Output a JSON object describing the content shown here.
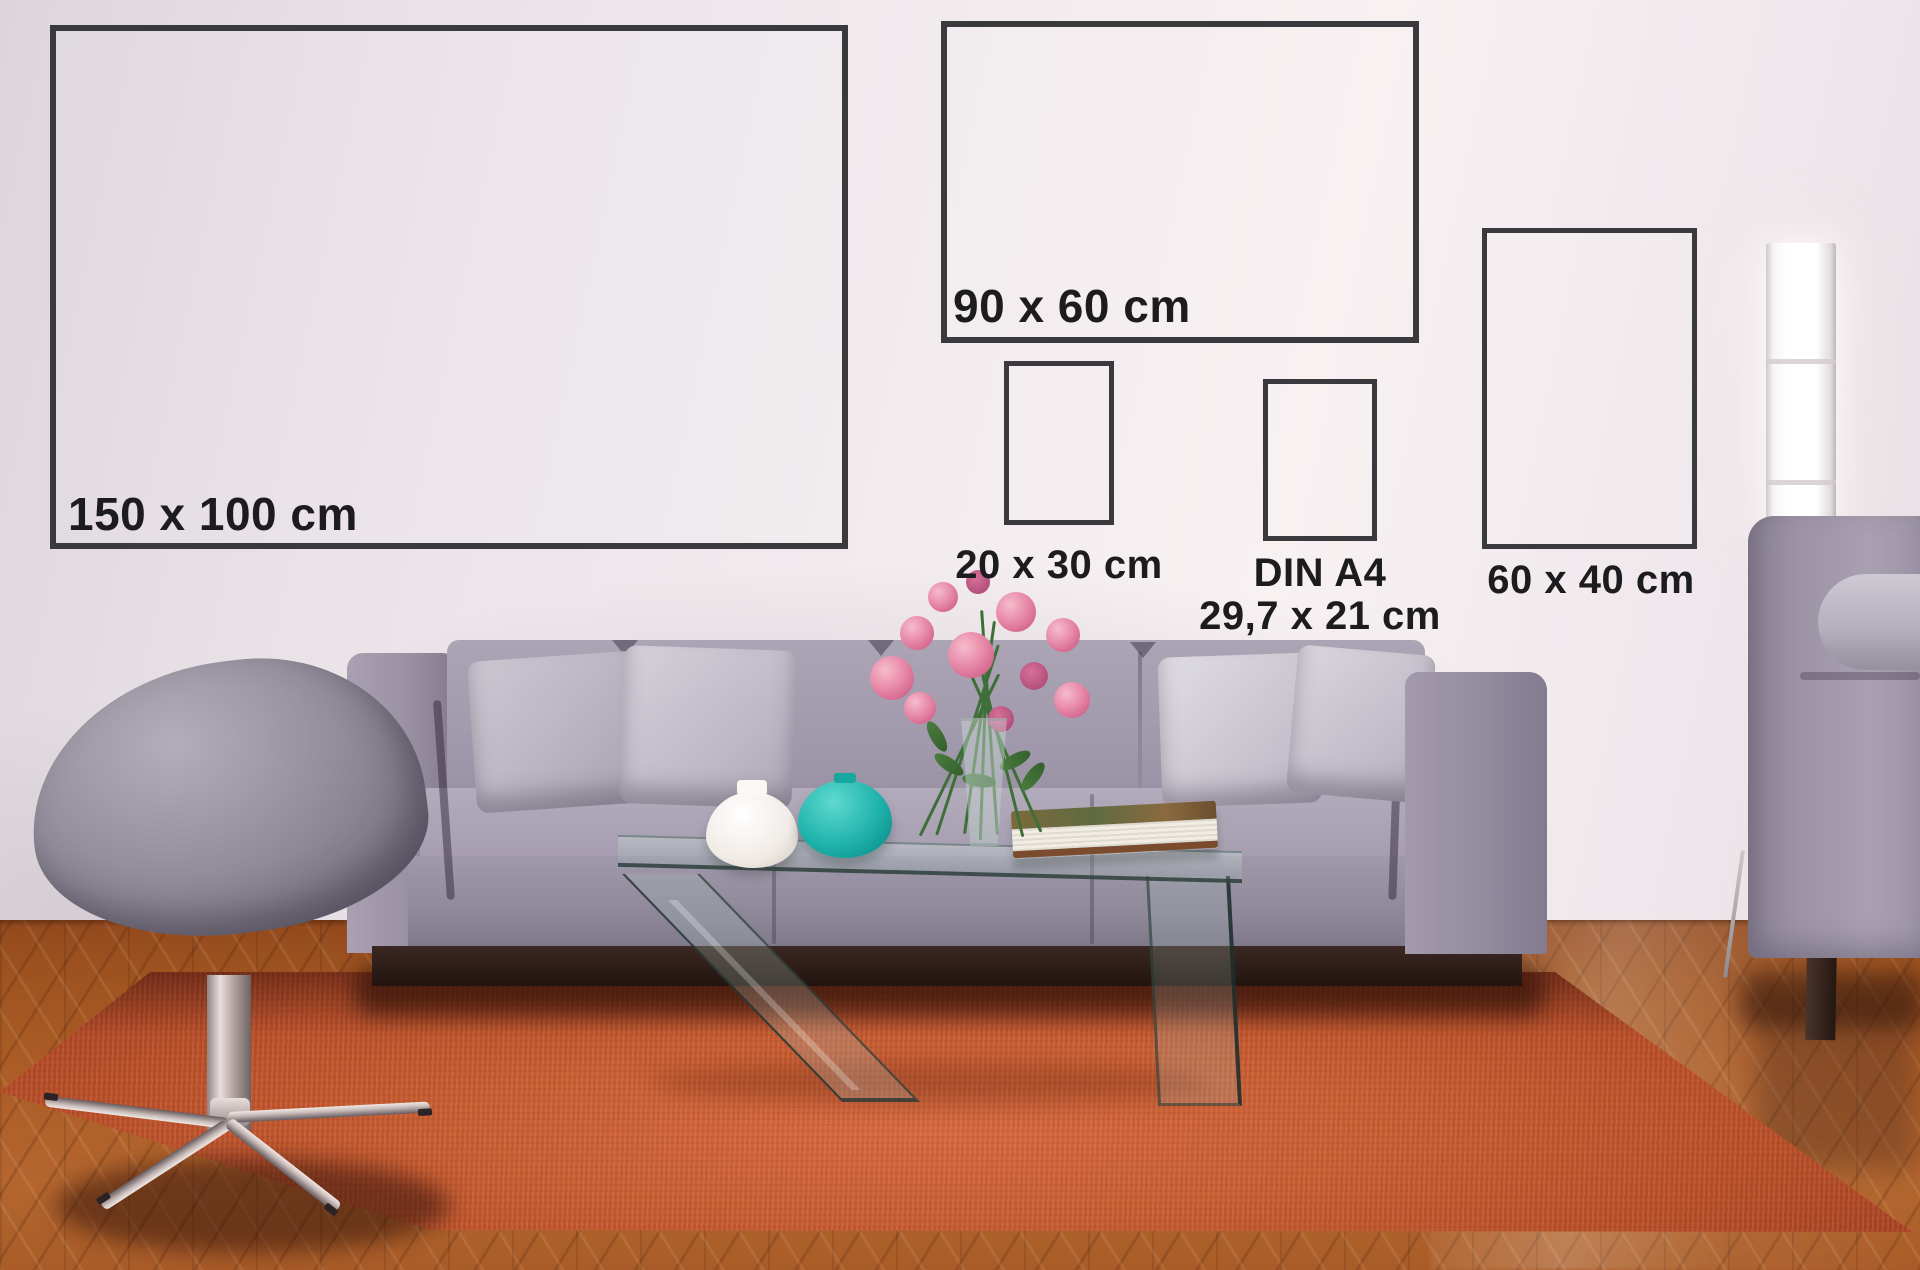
{
  "frames": [
    {
      "id": "150x100",
      "label": "150 x 100 cm"
    },
    {
      "id": "90x60",
      "label": "90 x 60 cm"
    },
    {
      "id": "20x30",
      "label": "20 x 30 cm"
    },
    {
      "id": "din_a4",
      "label": "DIN A4",
      "sublabel": "29,7 x 21 cm"
    },
    {
      "id": "60x40",
      "label": "60 x 40 cm"
    }
  ],
  "colors": {
    "frame_border": "#3a393e",
    "label_text": "#1c1b1e",
    "wall": "#f2ecef",
    "floor_wood": "#a65a27",
    "rug": "#c2522b",
    "sofa_fabric": "#9a93a3",
    "pillow_light": "#d6d3db",
    "white_vase": "#f4efec",
    "teal_vase": "#1fb3ab",
    "flower_pink": "#e27da1",
    "lamp_glow": "#ffffff",
    "plinth_dark": "#2f1d18"
  },
  "scene": {
    "objects": [
      "wall",
      "parquet-floor",
      "orange-rug",
      "sofa",
      "throw-pillows",
      "egg-stool",
      "glass-coffee-table",
      "flower-bouquet",
      "glass-vase",
      "white-vase",
      "teal-vase",
      "book",
      "floor-lamp",
      "armchair",
      "bolster-pillow"
    ]
  }
}
